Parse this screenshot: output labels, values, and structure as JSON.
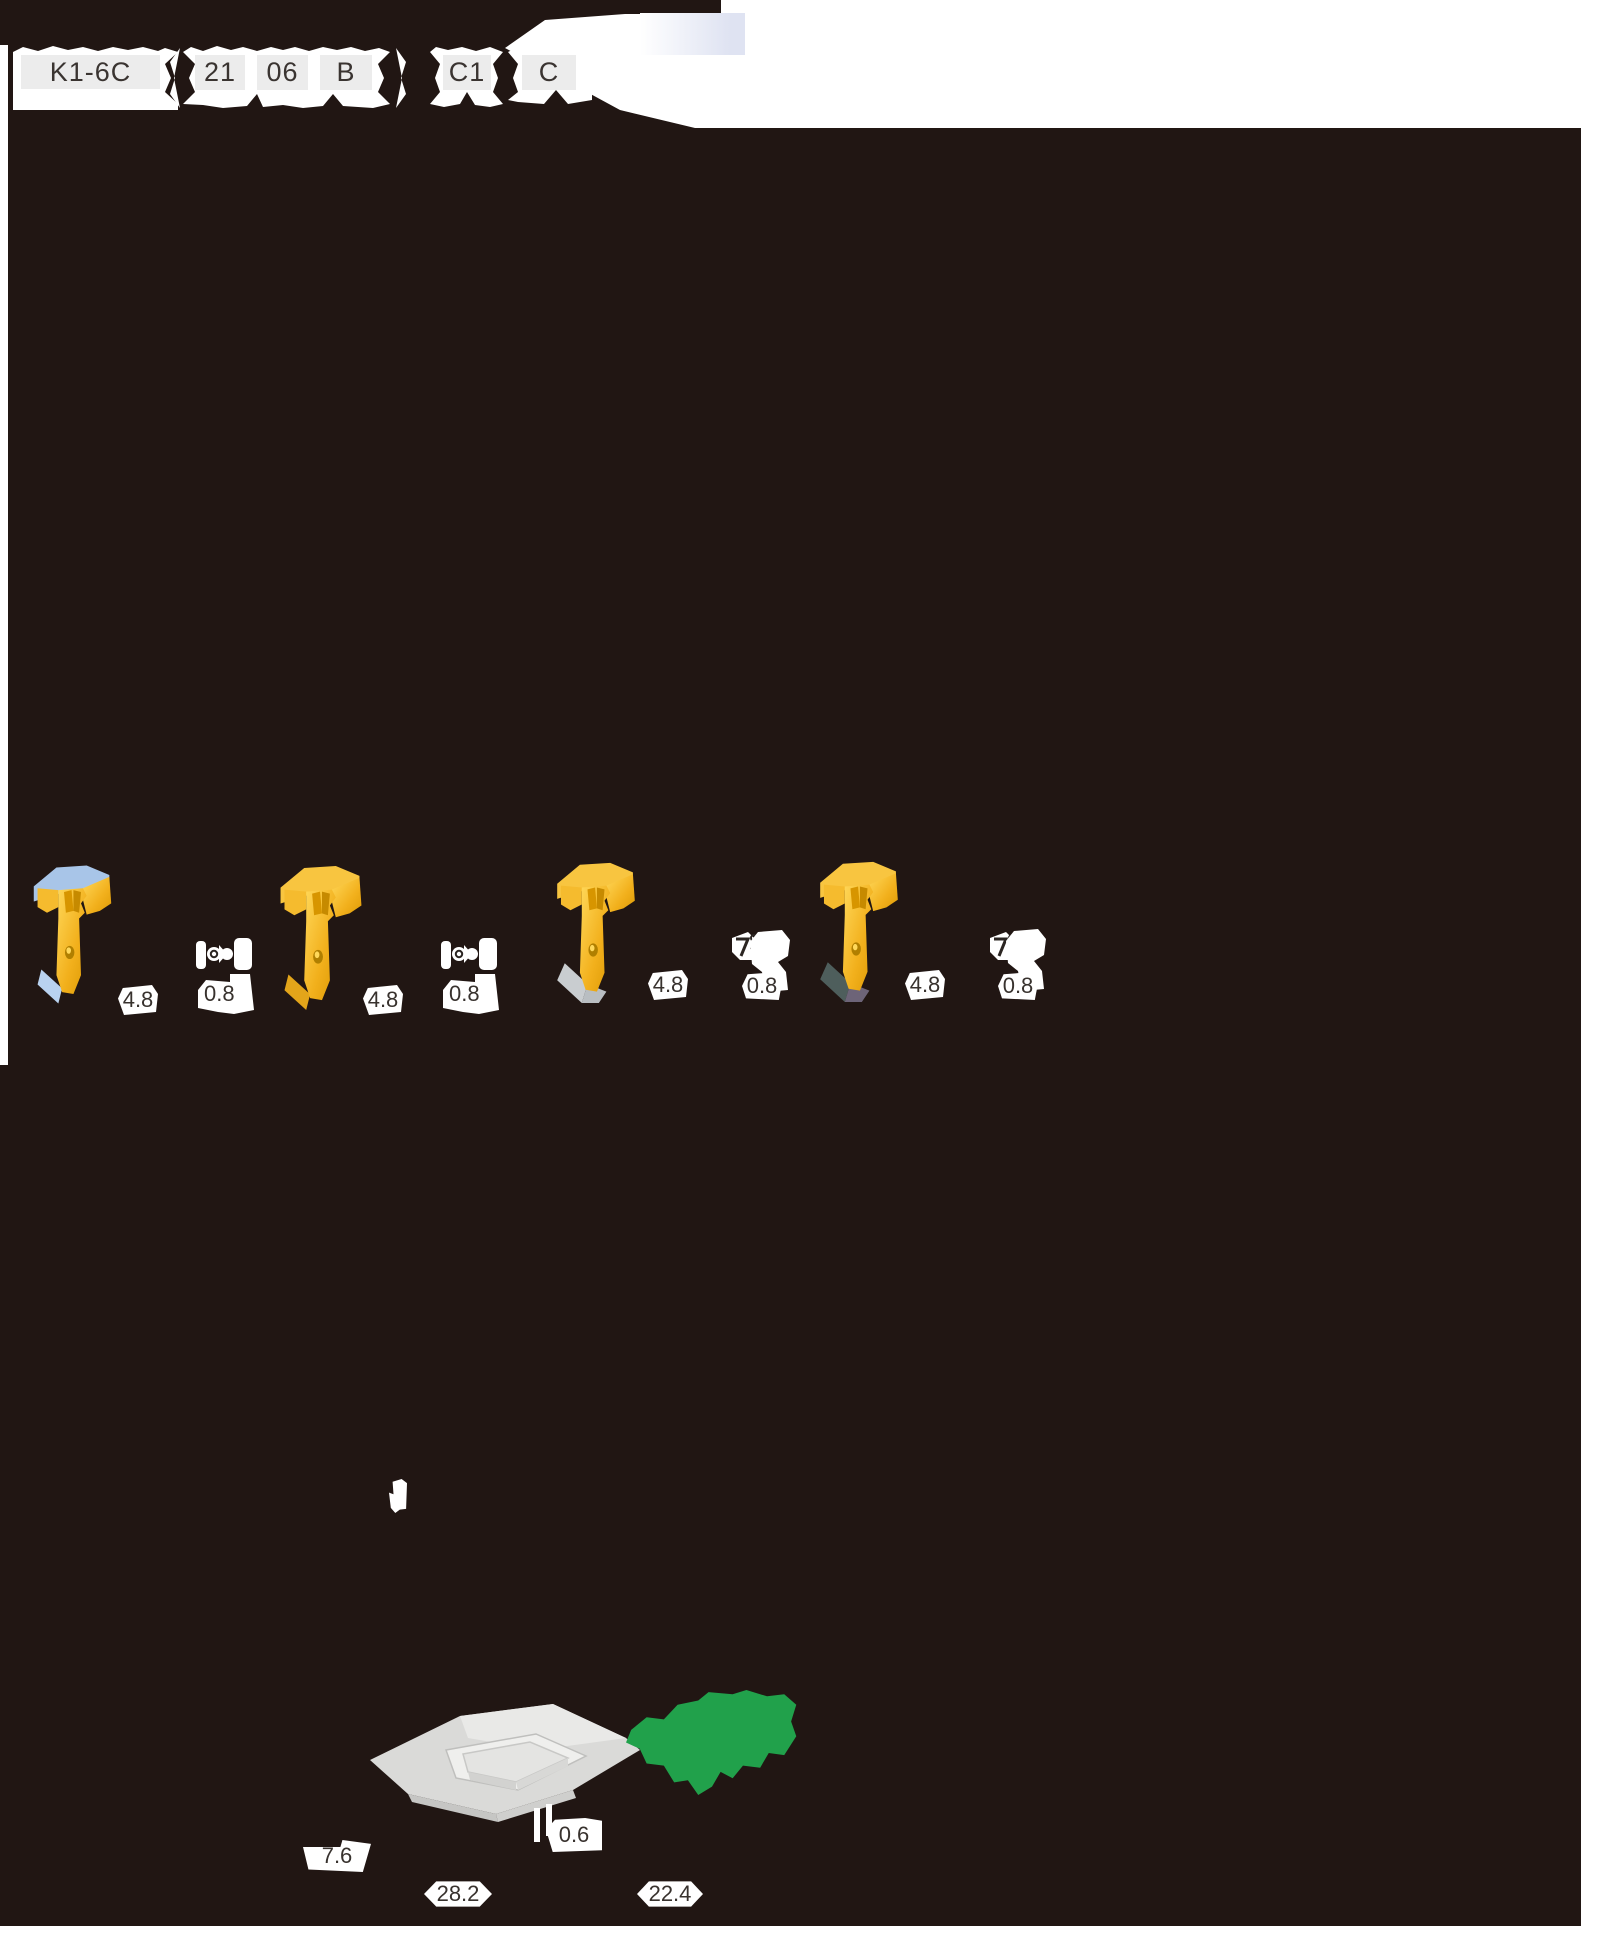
{
  "codes": {
    "family": "K1-6C",
    "size_a": "21",
    "size_b": "06",
    "style": "B",
    "breaker": "C1",
    "hand": "C"
  },
  "insert_groups": [
    {
      "width": "4.8",
      "radius": "0.8"
    },
    {
      "width": "4.8",
      "radius": "0.8"
    },
    {
      "width": "4.8",
      "radius": "0.8"
    },
    {
      "width": "4.8",
      "radius": "0.8"
    }
  ],
  "seat_dims": {
    "side": "7.6",
    "edge": "0.6",
    "length": "28.2",
    "width": "22.4"
  },
  "colors": {
    "background": "#211613",
    "insert_gold": "#f3b51f",
    "marker_green": "#21a14b",
    "shim_gray": "#d9d9d7",
    "code_box_gray": "#ececec",
    "corner_lavender": "#dfe3f2"
  }
}
